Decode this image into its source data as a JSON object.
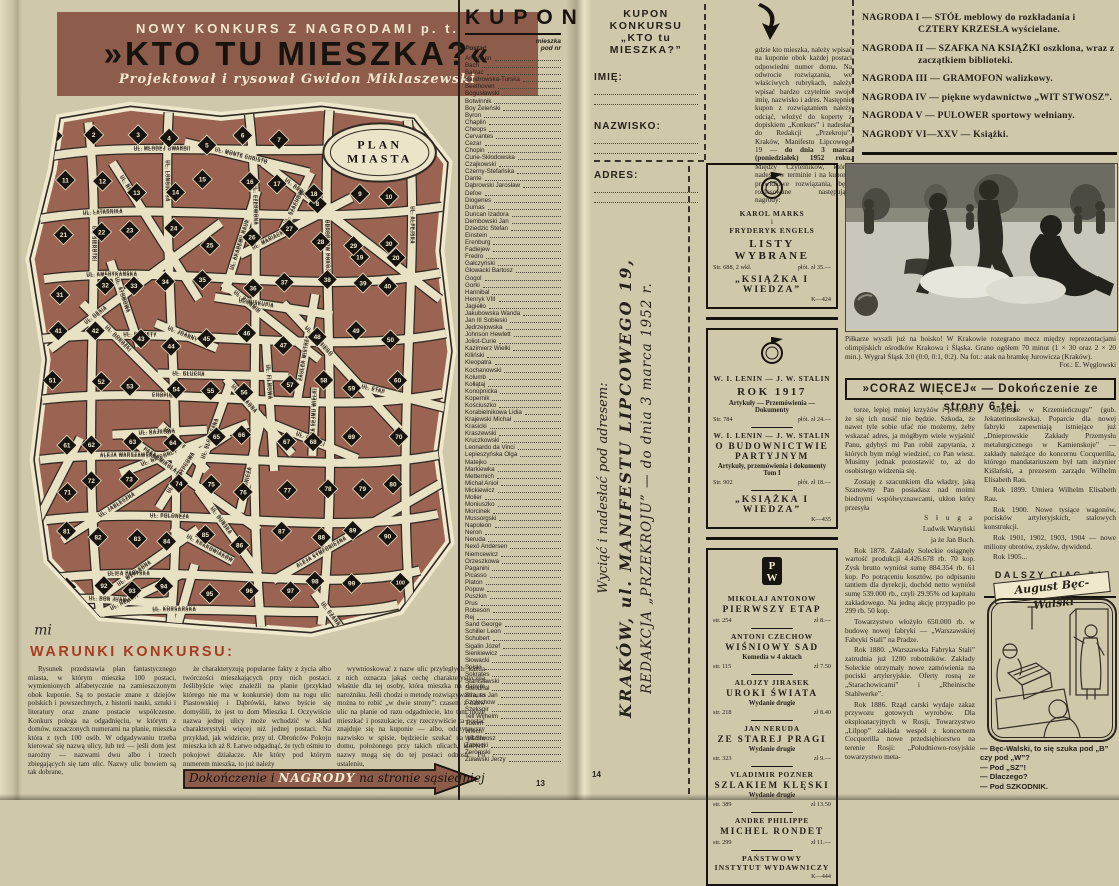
{
  "left_page": {
    "page_number": "13",
    "banner": {
      "kicker": "NOWY KONKURS Z NAGRODAMI p. t.",
      "title": "»KTO TU MIESZKA?«",
      "byline": "Projektował i rysował Gwidon Miklaszewski"
    },
    "map": {
      "label_line1": "PLAN",
      "label_line2": "MIASTA",
      "signature": "mi",
      "house_min": 1,
      "house_max": 100,
      "streets": [
        "UL. MŁODEJ GWARDII",
        "UL. LATARNIKA",
        "UL. AMERYKAŃSKA",
        "UL. RAKIETY",
        "CHOPINA",
        "ALEJA WARSZAWSKA",
        "UL. POLONEZA",
        "ULICA PARYSKA",
        "UL. KORSARSKA",
        "UL. SIEROTKI",
        "UL. LONGINUSA",
        "UL. CZERWONA",
        "OBROŃCÓW POKOJU",
        "UL. ALPEJSKA",
        "UL. GĘSIA",
        "UL. DRWALA",
        "UL. JABŁECZNA",
        "ALEJA SYMFONICZNA",
        "UL. BECZKI",
        "UL. HRABIEGO",
        "PASAŻ MIKOŁAJA",
        "UL. PIRAMID",
        "UL. DOROŻKI",
        "UL. DON JUANA"
      ],
      "extra_streets": [
        "UL. SŁONECZNA",
        "UL. ETAP",
        "UL. FILMOWA",
        "UL. SKRZYPCOWA",
        "UL. ATOMOWA",
        "UL. AKADEMII NAUK",
        "UL. WZGLĘDNA",
        "UL. BURZY",
        "UL. CZARNA",
        "ZAUŁEK MISTRZA",
        "UL. MARIACKA",
        "UL. MONTE CHRISTO",
        "UL. FARAONA",
        "UL. SZACHÓW",
        "UL. BAJKOWA",
        "UL. BISKUPIA",
        "UL. DUŃSKA",
        "UL. KRAKOWIAKÓW",
        "UL. GÓRALI",
        "UL. HELENY",
        "UL. FUGI",
        "UL. GŁUCHA",
        "UL. JOANNY",
        "ALEJA SEJMU WIELKIEGO",
        "UL. GIOCONDY",
        "GÓRNICZA",
        "UL. JACKA"
      ]
    },
    "rules": {
      "heading": "WARUNKI KONKURSU:",
      "col1": "Rysunek przedstawia plan fantastycznego miasta, w którym mieszka 100 postaci, wymienionych alfabetycznie na zamieszczonym obok kuponie. Są to postacie znane z dziejów polskich i powszechnych, z historii nauki, sztuki i literatury oraz znane postacie współczesne. Konkurs polega na odgadnięciu, w którym z domów, oznaczonych numerami na planie, mieszka która z tych 100 osób. W odgadywaniu trzeba kierować się nazwą ulicy, lub też — jeśli dom jest narożny — nazwami dwu albo i trzech zbiegających się tam ulic. Nazwy ulic bowiem są tak dobrane,",
      "col2": "że charakteryzują popularne fakty z życia albo twórczości mieszkających przy nich postaci. Jeślibyście więc znaleźli na planie (przykład którego nie ma w konkursie) dom na rogu ulic Piastowskiej i Dąbrówki, łatwo byście się domyślili, że jest to dom Mieszka I. Oczywiście nazwa jednej ulicy może wchodzić w skład charakterystyki więcej niż jednej postaci. Na przykład, jak widzicie, przy ul. Obrońców Pokoju mieszka ich aż 8. Łatwo odgadnąć, że tych ośmiu to pokojowi działacze. Ale który pod którym numerem mieszka, to już należy",
      "col3": "wywnioskować z nazw ulic przyległych: każda z nich oznacza jakąś cechę charakterystyczną właśnie dla tej osoby, która mieszka na danym narożniku. Jeśli chodzi o metodę rozwiązywania, to można to robić „w dwie strony”: czasem z nazw ulic na planie od razu odgadniecie, kto tam może mieszkać i poszukacie, czy rzeczywiście ta postać znajduje się na kuponie — albo, odczytawszy nazwisko w spisie, będziecie szukać na planie domu, położonego przy takich ulicach, których nazwy mogą się do tej postaci odnosić. Po ustaleniu,"
    },
    "arrow_banner": {
      "pre": "Dokończenie i ",
      "em": "NAGRODY",
      "post": " na stronie sąsiedniej"
    },
    "coupon": {
      "title": "KUPON",
      "col_person": "Postać",
      "nr_line1": "mieszka",
      "nr_line2": "pod nr",
      "names": [
        "Andersen",
        "Bach",
        "Balzac",
        "Bandrowska-Turska",
        "Beethoven",
        "Bogusławski",
        "Botwinnik",
        "Boy Żeleński",
        "Byron",
        "Chaplin",
        "Cheops",
        "Cervantes",
        "Cezar",
        "Chopin",
        "Curie-Skłodowska",
        "Czajkowski",
        "Czerny-Stefańska",
        "Dante",
        "Dąbrowski Jarosław",
        "Defoe",
        "Diogenes",
        "Dumas",
        "Duncan Izadora",
        "Dembowski Jan",
        "Dziedzic Stefan",
        "Einstein",
        "Erenburg",
        "Fadiejew",
        "Fredro",
        "Gałczyński",
        "Głowacki Bartosz",
        "Gogol",
        "Gorki",
        "Hannibal",
        "Henryk VIII",
        "Jagiełło",
        "Jakubowska Wanda",
        "Jan III Sobieski",
        "Jędrzejowska",
        "Johnson Hewlett",
        "Joliot-Curie",
        "Kazimierz Wielki",
        "Kiliński",
        "Kleopatra",
        "Kochanowski",
        "Kolumb",
        "Kołłątaj",
        "Konopnicka",
        "Kopernik",
        "Kościuszko",
        "Korabielnikowa Lidia",
        "Krajewski Michał",
        "Krasicki",
        "Kraszewski",
        "Kruczkowski",
        "Leonardo da Vinci",
        "Lepieszyńska Olga",
        "Matejko",
        "Markiewka",
        "Metternich",
        "Michał Anioł",
        "Mickiewicz",
        "Molier",
        "Moniuszko",
        "Morcinek",
        "Mussorgski",
        "Napoleon",
        "Neron",
        "Neruda",
        "Nexö Andersen",
        "Niemcewicz",
        "Orzeszkowa",
        "Paganini",
        "Picasso",
        "Platon",
        "Popow",
        "Puszkin",
        "Prus",
        "Robeson",
        "Rej",
        "Sand George",
        "Schiller Leon",
        "Schubert",
        "Sigalin Józef",
        "Sienkiewicz",
        "Słowacki",
        "Solski",
        "Sokrates",
        "Stanisławski",
        "Stendhal",
        "Strauss Jan",
        "Szołochow",
        "Szekspir",
        "Tell Wilhelm",
        "Tuwim",
        "Wiech",
        "Wit Stwosz",
        "Zabłocki",
        "Żeromski",
        "Żuławski Jerzy"
      ]
    }
  },
  "right_page": {
    "page_number": "14",
    "coupon_form": {
      "title1": "KUPON KONKURSU",
      "title2": "„KTO tu MIESZKA?”",
      "fields": [
        "IMIĘ:",
        "NAZWISKO:",
        "ADRES:"
      ]
    },
    "instructions": {
      "pre": "gdzie kto mieszka, należy wpisać na kuponie obok każdej postaci odpowiedni numer domu. Na odwrocie rozwiązania, we właściwych rubrykach, należy wpisać bardzo czytelnie swoje imię, nazwisko i adres. Następnie kupon z rozwiązaniem należy odciąć, włożyć do koperty z dopiskiem „Konkurs” i nadesłać do Redakcji „Przekroju”, Kraków, Manifestu Lipcowego 19 — ",
      "bold": "do dnia 3 marca (poniedziałek) 1952 roku.",
      "post": " Między Czytelników, którzy nadeślą w terminie i na kuponie prawidłowe rozwiązania, będą rozlosowane następujące nagrody:"
    },
    "cut_note": {
      "line1": "Wyciąć i nadesłać pod adresem:",
      "line2": "KRAKÓW, ul. MANIFESTU LIPCOWEGO 19,",
      "line3": "REDAKCJA „PRZEKROJU” — do dnia 3 marca 1952 r."
    },
    "prizes": [
      "NAGRODA I — STÓŁ meblowy do rozkładania i CZTERY KRZESŁA wyścielane.",
      "NAGRODA II — SZAFKA NA KSIĄŻKI oszklona, wraz z zaczątkiem biblioteki.",
      "NAGRODA III — GRAMOFON walizkowy.",
      "NAGRODA IV — piękne wydawnictwo „WIT STWOSZ”.",
      "NAGRODA V — PULOWER sportowy wełniany.",
      "NAGRODY VI—XXV — Książki."
    ],
    "ads": [
      {
        "name": "kiw-marks-engels",
        "blocks": [
          {
            "type": "logo",
            "icon": "kiw-badge-icon"
          },
          {
            "type": "line",
            "text": "KAROL MARKS"
          },
          {
            "type": "small",
            "text": "i"
          },
          {
            "type": "line",
            "text": "FRYDERYK ENGELS"
          },
          {
            "type": "title",
            "text": "LISTY WYBRANE"
          },
          {
            "type": "row",
            "left": "Str. 688, 2 wkł.",
            "right": "płót. zł 35.—"
          },
          {
            "type": "footer",
            "text": "„KSIĄŻKA I WIEDZA”"
          },
          {
            "type": "code",
            "text": "K—424"
          }
        ]
      },
      {
        "name": "kiw-lenin-stalin",
        "blocks": [
          {
            "type": "logo",
            "icon": "kiw-badge-icon"
          },
          {
            "type": "line",
            "text": "W. I. LENIN — J. W. STALIN"
          },
          {
            "type": "title",
            "text": "ROK 1917"
          },
          {
            "type": "sub",
            "text": "Artykuły — Przemówienia — Dokumenty"
          },
          {
            "type": "row",
            "left": "Str. 784",
            "right": "płót. zł 24.—"
          },
          {
            "type": "rule"
          },
          {
            "type": "line",
            "text": "W. I. LENIN — J. W. STALIN"
          },
          {
            "type": "title2",
            "text": "O BUDOWNICTWIE PARTYJNYM"
          },
          {
            "type": "sub",
            "text": "Artykuły, przemówienia i dokumenty"
          },
          {
            "type": "sub",
            "text": "Tom I"
          },
          {
            "type": "row",
            "left": "Str. 902",
            "right": "płót. zł 18.—"
          },
          {
            "type": "rule"
          },
          {
            "type": "footer",
            "text": "„KSIĄŻKA I WIEDZA”"
          },
          {
            "type": "code",
            "text": "K—435"
          }
        ]
      },
      {
        "name": "piw-books",
        "blocks": [
          {
            "type": "logo",
            "icon": "piw-monogram-icon"
          },
          {
            "type": "line",
            "text": "MIKOŁAJ ANTONOW"
          },
          {
            "type": "title2",
            "text": "PIERWSZY ETAP"
          },
          {
            "type": "row",
            "left": "str. 254",
            "right": "zł 8.—"
          },
          {
            "type": "rule"
          },
          {
            "type": "line",
            "text": "ANTONI CZECHOW"
          },
          {
            "type": "title2",
            "text": "WIŚNIOWY SAD"
          },
          {
            "type": "sub",
            "text": "Komedia w 4 aktach"
          },
          {
            "type": "row",
            "left": "str. 115",
            "right": "zł 7.50"
          },
          {
            "type": "rule"
          },
          {
            "type": "line",
            "text": "ALOJZY JIRASEK"
          },
          {
            "type": "title2",
            "text": "UROKI ŚWIATA"
          },
          {
            "type": "sub",
            "text": "Wydanie drugie"
          },
          {
            "type": "row",
            "left": "str. 218",
            "right": "zł 8.40"
          },
          {
            "type": "rule"
          },
          {
            "type": "line",
            "text": "JAN NERUDA"
          },
          {
            "type": "title2",
            "text": "ZE STAREJ PRAGI"
          },
          {
            "type": "sub",
            "text": "Wydanie drugie"
          },
          {
            "type": "row",
            "left": "str. 323",
            "right": "zł 9.—"
          },
          {
            "type": "rule"
          },
          {
            "type": "line",
            "text": "VLADIMIR POZNER"
          },
          {
            "type": "title2",
            "text": "SZLAKIEM KLĘSKI"
          },
          {
            "type": "sub",
            "text": "Wydanie drugie"
          },
          {
            "type": "row",
            "left": "str. 389",
            "right": "zł 13.50"
          },
          {
            "type": "rule"
          },
          {
            "type": "line",
            "text": "ANDRE PHILIPPE"
          },
          {
            "type": "title2",
            "text": "MICHEL RONDET"
          },
          {
            "type": "row",
            "left": "str. 299",
            "right": "zł 11.—"
          },
          {
            "type": "rule"
          },
          {
            "type": "footer2",
            "text": "PAŃSTWOWY"
          },
          {
            "type": "footer2",
            "text": "INSTYTUT WYDAWNICZY"
          },
          {
            "type": "code",
            "text": "K—444"
          }
        ]
      }
    ],
    "photo": {
      "caption": "Piłkarze wyszli już na boisko! W Krakowie rozegrano mecz między reprezentacjami olimpijskich ośrodków Krakowa i Śląska. Grano ogółem 70 minut (1 × 30 oraz 2 × 20 min.). Wygrał Śląsk 3:0 (0:0, 0:1, 0:2). Na fot.: atak na bramkę Jurowicza (Kraków).",
      "credit": "Fot.: E. Węglowski"
    },
    "article": {
      "headline": "»CORAZ WIĘCEJ« — Dokończenie ze strony 6-tej",
      "col1": [
        {
          "type": "p",
          "text": "torze, lepiej mniej krzyżów i pewność, że się ich nosić nie będzie. Szkoda, że nawet tyle sobie ufać nie możemy, żeby wskazać adres, ja mógłbym wiele wyjaśnić Panu, gdybyś mi Pan robił zapytania, z których bym mógł wiedzieć, co Pan wiesz. Musimy jednak pozostawić to, aż do osobistego widzenia się."
        },
        {
          "type": "p",
          "text": "Zostaję z szacunkiem dla władzy, jaką Szanowny Pan posiadasz nad moimi biednymi współwyznawcami, ukłon który przesyła"
        },
        {
          "type": "sig",
          "lines": [
            "S ł u g a",
            "Ludwik Waryński",
            "ja że Jan Buch."
          ]
        },
        {
          "type": "p",
          "text": "Rok 1878. Zakłady Soleckie osiągnęły wartość produkcji 4.426.678 rb. 70 kop. Zysk brutto wyniósł sumę 884.354 rb. 61 kop. Po potrąceniu kosztów, po odpisaniu tantiem dla dyrekcji, dochód netto wyniósł sumę 539.000 rb., czyli 29.95% od kapitału zakładowego. Na jedną akcję przypadło po 299 rb. 50 kop."
        },
        {
          "type": "p",
          "text": "Towarzystwo włożyło 650.000 rb. w budowę nowej fabryki — „Warszawskiej Fabryki Stali” na Pradze."
        },
        {
          "type": "p",
          "text": "Rok 1880. „Warszawska Fabryka Stali” zatrudnia już 1200 robotników. Zakłady Soleckie otrzymały nowe zamówienia na pociski artyleryjskie. Oferty rosną ze „Starachowicami” i „Rheinische Stahlwerke”."
        },
        {
          "type": "p",
          "text": "Rok 1886. Rząd carski wydaje zakaz przywozu gotowych wyrobów. Dla eksploatacyjnych w Rosji, Towarzystwo „Lilpop” zakłada wespół z koncernem Cocquerilla nowe przedsiębiorstwo na terenie Rosji: „Południowo-rosyjskie towarzystwo meta-"
        }
      ],
      "col2": [
        {
          "type": "p",
          "text": "lurgiczne w Krzemieńczugu” (gub. Jekaterinosławska). Poparcie dla nowej fabryki zapewniają istniejące już „Dnieprowskie Zakłady Przemysłu metalurgicznego w Kamienskoje” — zakłady należące do koncernu Cocquerilla, którego mandatariuszem był tam inżynier Kiślański, a prezesem zarządu Wilhelm Elisabeth Rau."
        },
        {
          "type": "p",
          "text": "Rok 1899. Umiera Wilhelm Elisabeth Rau."
        },
        {
          "type": "p",
          "text": "Rok 1900. Nowe tysiące wagonów, pocisków artyleryjskich, stalowych konstrukcji."
        },
        {
          "type": "p",
          "text": "Rok 1901, 1902, 1903, 1904 — nowe miliony obrotów, zysków, dywidend."
        },
        {
          "type": "p",
          "text": "Rok 1905..."
        }
      ],
      "footer": "DALSZY CIĄG ZA TYDZIEŃ"
    },
    "comic": {
      "banner": "August Bęc-Walski",
      "captions": [
        "— Bęc-Walski, to się szuka pod „B”",
        "czy pod „W”?",
        "— Pod „SZ”!",
        "— Dlaczego?",
        "— Pod SZKODNIK."
      ]
    }
  }
}
